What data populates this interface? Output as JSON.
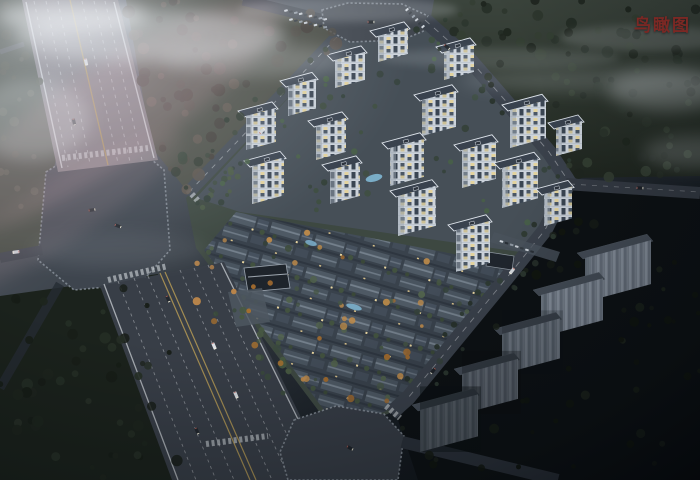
{
  "page": {
    "view_label": "鸟瞰图"
  },
  "palette": {
    "label_red": "#7b2824",
    "tower_facade": "#ccd3db",
    "tower_roof": "#39424e",
    "lit_window": "#e3d39e",
    "villa_roof": "#4e5964",
    "forest_dark": "#27302a",
    "asphalt": "#3c434c",
    "lane_yellow": "#b59a55",
    "lane_white": "#d6dade",
    "slab_gray": "#79828e",
    "pool_blue": "#7fb7d4",
    "autumn_orange": "#b5803f",
    "cloud_white": "#edf1f6"
  },
  "scene": {
    "highrise_tower_count": 17,
    "unlit_building_count": 5
  }
}
